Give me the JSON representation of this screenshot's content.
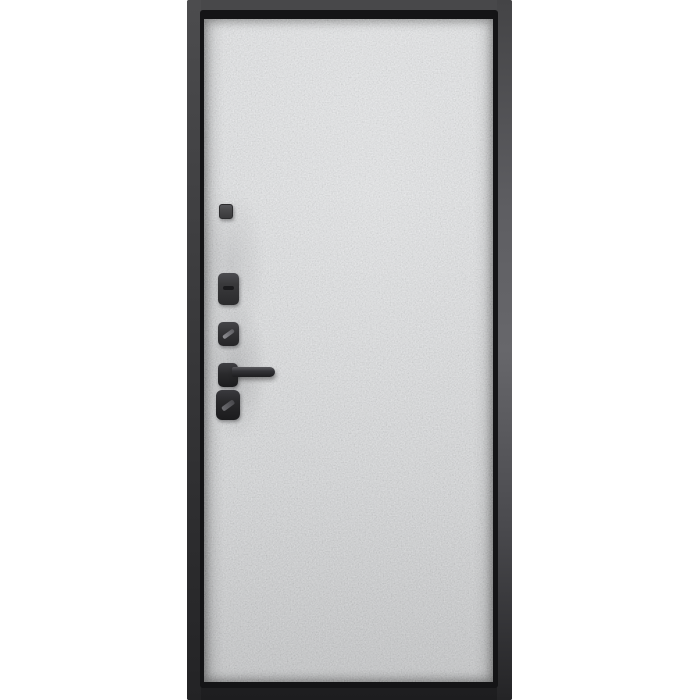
{
  "meta": {
    "content_type": "product-photo",
    "description": "Steel entrance door, interior side: light gray concrete-textured panel set in a dark charcoal metal frame, with black matte hardware on the left edge",
    "background_color": "#ffffff"
  },
  "palette": {
    "background": "#ffffff",
    "frame_top": "#48484a",
    "frame_bottom": "#1d1d1f",
    "frame_right_light": "#67676b",
    "groove": "#141416",
    "panel_base": "#eef0f2",
    "panel_apparent_gray": "#c6c7c9",
    "hardware_dark": "#232325",
    "hardware_mid": "#3a3a3c",
    "keyhole_highlight": "#8e8e92"
  },
  "door": {
    "name": "entry-door",
    "panel_finish": "gray concrete texture",
    "hardware": [
      {
        "name": "peephole",
        "label": "peephole cover"
      },
      {
        "name": "thumbturn-escutcheon",
        "label": "thumb-turn escutcheon"
      },
      {
        "name": "upper-lock-cylinder",
        "label": "upper lock keyhole"
      },
      {
        "name": "door-handle",
        "label": "lever door handle"
      },
      {
        "name": "lower-lock-cylinder",
        "label": "lower lock keyhole"
      }
    ]
  }
}
